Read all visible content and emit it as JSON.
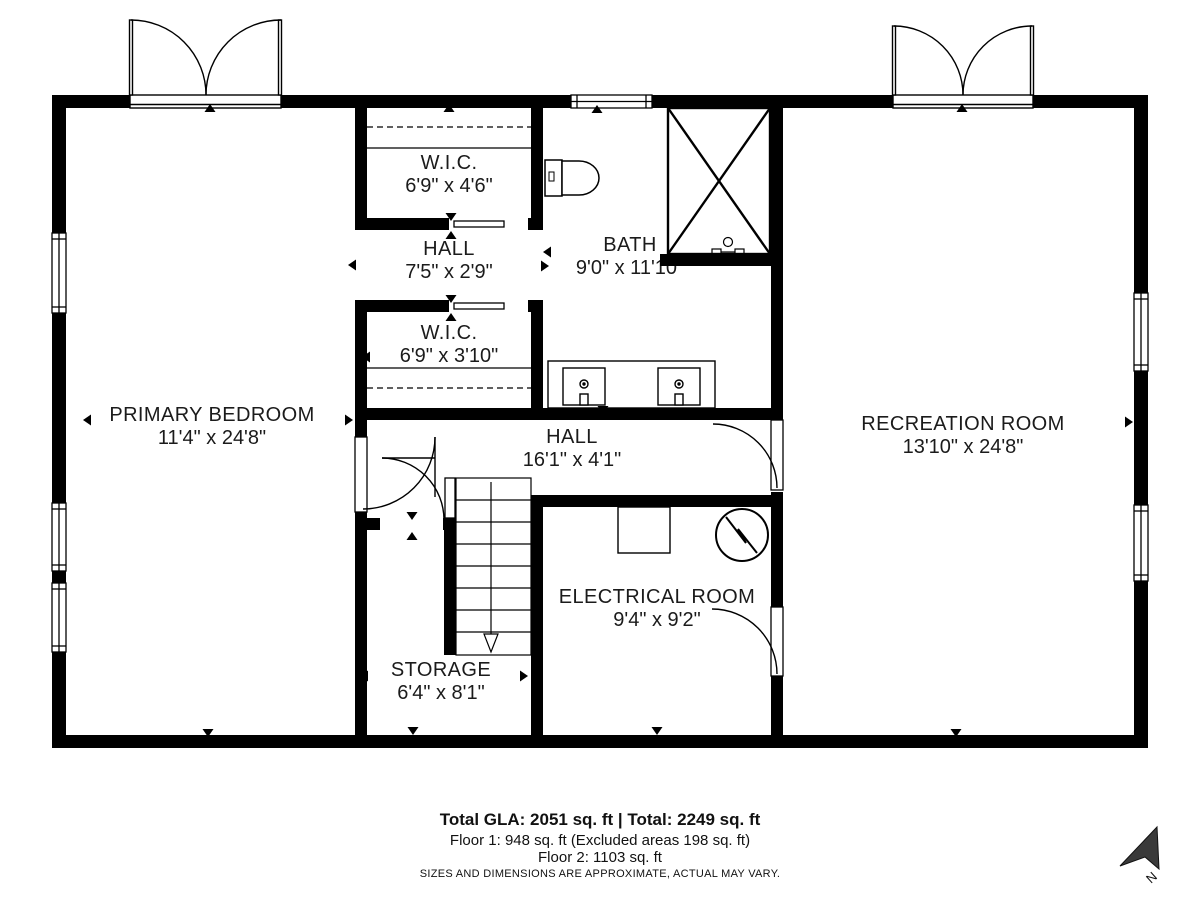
{
  "colors": {
    "wall": "#000000",
    "background": "#ffffff",
    "text": "#1b1b1b",
    "compass": "#3a3a3a"
  },
  "rooms": [
    {
      "name": "PRIMARY BEDROOM",
      "dims": "11'4\" x 24'8\""
    },
    {
      "name": "W.I.C.",
      "dims": "6'9\" x 4'6\""
    },
    {
      "name": "HALL",
      "dims": "7'5\" x 2'9\""
    },
    {
      "name": "BATH",
      "dims": "9'0\" x 11'10\""
    },
    {
      "name": "W.I.C.",
      "dims": "6'9\" x 3'10\""
    },
    {
      "name": "HALL",
      "dims": "16'1\" x 4'1\""
    },
    {
      "name": "RECREATION ROOM",
      "dims": "13'10\" x 24'8\""
    },
    {
      "name": "ELECTRICAL ROOM",
      "dims": "9'4\" x 9'2\""
    },
    {
      "name": "STORAGE",
      "dims": "6'4\" x 8'1\""
    }
  ],
  "fixtures": [
    "shower-icon",
    "toilet-icon",
    "sink-icon",
    "staircase-down-icon",
    "electrical-panel-icon",
    "electric-meter-icon",
    "window-icon",
    "double-door-icon"
  ],
  "footer": {
    "line1": "Total GLA: 2051 sq. ft | Total: 2249 sq. ft",
    "line2": "Floor 1: 948 sq. ft (Excluded areas 198 sq. ft)",
    "line3": "Floor 2: 1103 sq. ft",
    "disclaimer": "SIZES AND DIMENSIONS ARE APPROXIMATE, ACTUAL MAY VARY."
  },
  "compass": {
    "label": "N"
  }
}
